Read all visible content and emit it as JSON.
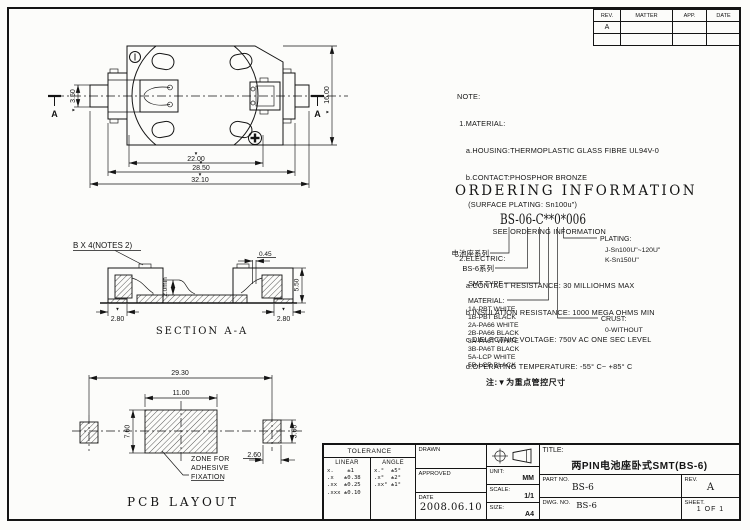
{
  "marker": "▼",
  "revision_table": {
    "col_rev": "REV.",
    "col_matter": "MATTER",
    "col_app": "APP.",
    "col_date": "DATE",
    "row1_rev": "A"
  },
  "notes": {
    "lines": [
      "NOTE:",
      " 1.MATERIAL:",
      "    a.HOUSING:THERMOPLASTIC GLASS FIBRE UL94V-0",
      "    b.CONTACT:PHOSPHOR BRONZE",
      "     (SURFACE PLATING: Sn100u\")",
      "                SEE ORDERING INFORMATION",
      " 2.ELECTRIC:",
      "    a.CONTACT RESISTANCE: 30 MILLIOHMS MAX",
      "    b.INSULATION RESISTANCE: 1000 MEGA OHMS MIN",
      "    c.DIELECTNIC VOLTAGE: 750V AC ONE SEC LEVEL",
      "    d.OPERATING TEMPERATURE: -55° C~ +85° C"
    ]
  },
  "ordering": {
    "heading": "ORDERING INFORMATION",
    "part_number": "BS-06-C**0*006",
    "series_label": "电池座系列",
    "series2_label": "BS-6系列",
    "smt_label": "SMT TYPE",
    "material_label": "MATERIAL:",
    "materials": [
      "1A-PBT WHITE",
      "1B-PBT BLACK",
      "2A-PA66 WHITE",
      "2B-PA66 BLACK",
      "3A-PA6T WHITE",
      "3B-PA6T BLACK",
      "5A-LCP WHITE",
      "5B-LCP BLACK"
    ],
    "plating_label": "PLATING:",
    "plating_options": [
      "J-Sn100U\"~120U\"",
      "K-Sn150U\""
    ],
    "crust_label": "CRUST:",
    "crust_options": [
      "0-WITHOUT"
    ],
    "footnote": "注:▼为重点管控尺寸"
  },
  "top_view": {
    "dim_tab": "3.50",
    "dim_height": "16.00",
    "dim_inner": "22.00",
    "dim_mid": "28.50",
    "dim_outer": "32.10",
    "section_a_left": "A",
    "section_a_right": "A"
  },
  "section_view": {
    "caption": "SECTION A-A",
    "callout": "B X 4(NOTES 2)",
    "dim_min": "2.0min",
    "dim_slot": "0.45",
    "dim_height": "5.50",
    "dim_foot_left": "2.80",
    "dim_foot_right": "2.80"
  },
  "pcb_view": {
    "caption": "PCB LAYOUT",
    "dim_span": "29.30",
    "dim_zone_w": "11.00",
    "dim_zone_h": "7.60",
    "dim_pad_h": "3.60",
    "dim_pad_w": "2.60",
    "zone_label": [
      "ZONE FOR",
      "ADHESIVE",
      "FIXATION"
    ]
  },
  "title_block": {
    "tolerance_title": "TOLERANCE",
    "linear_title": "LINEAR",
    "angle_title": "ANGLE",
    "linear_rows": "x.    ±1\n.x   ±0.38\n.xx  ±0.25\n.xxx ±0.10",
    "angle_rows": "x.°  ±5°\n.x°  ±2°\n.xx° ±1°",
    "drawn_label": "DRAWN",
    "approved_label": "APPROVED",
    "date_label": "DATE",
    "date_value": "2008.06.10",
    "unit_label": "UNIT:",
    "unit_value": "MM",
    "scale_label": "SCALE:",
    "scale_value": "1/1",
    "size_label": "SIZE:",
    "size_value": "A4",
    "title_label": "TITLE:",
    "title_value": "两PIN电池座卧式SMT(BS-6)",
    "part_no_label": "PART NO.",
    "part_no_value": "BS-6",
    "rev_label": "REV.",
    "rev_value": "A",
    "dwg_label": "DWG. NO.",
    "dwg_value": "BS-6",
    "sheet_label": "SHEET.",
    "sheet_value": "1 OF 1"
  }
}
